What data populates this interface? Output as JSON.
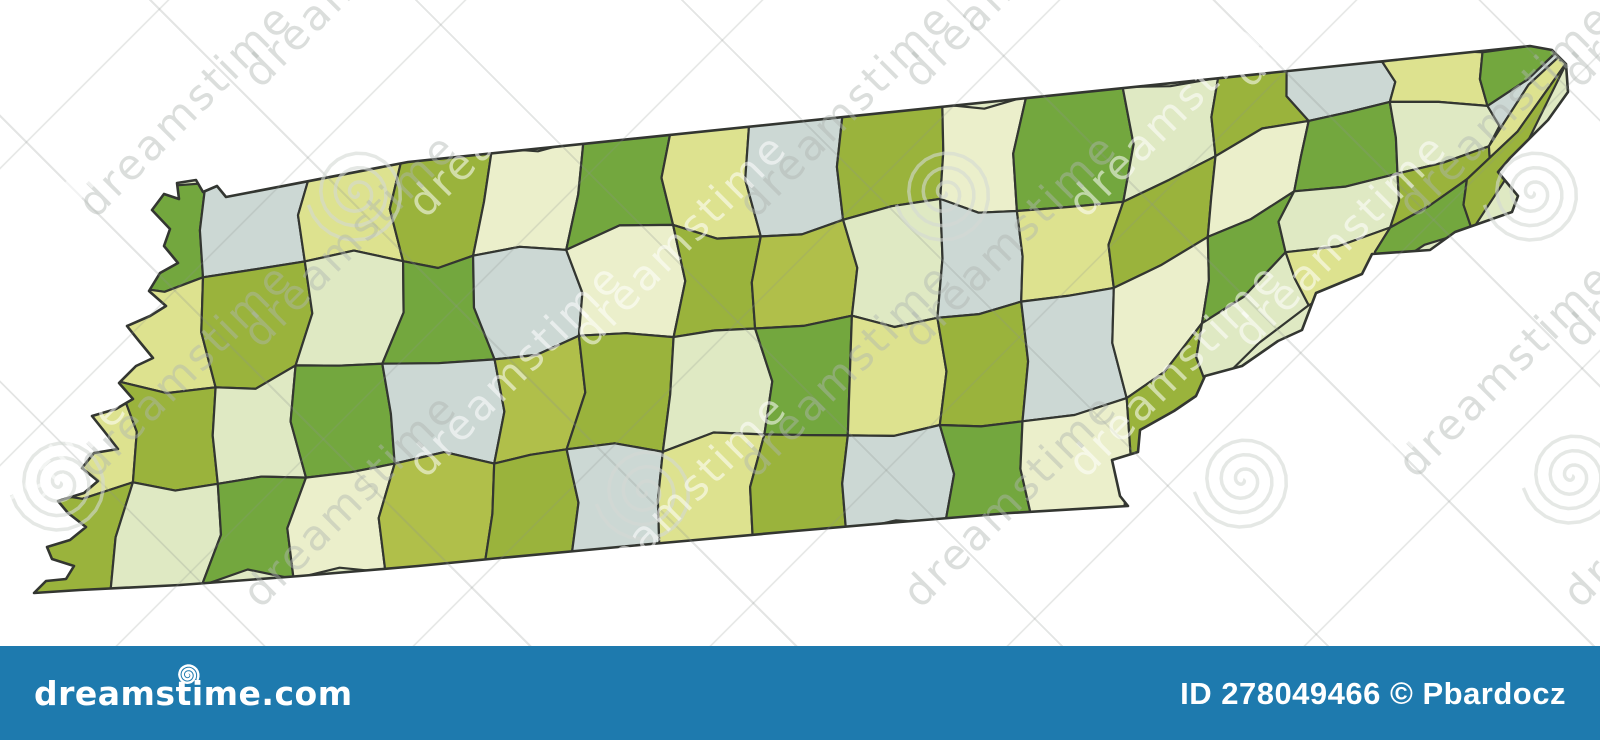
{
  "image": {
    "width": 1600,
    "height": 740,
    "background": "#ffffff"
  },
  "map": {
    "label": "tennessee-counties-political-map",
    "border_color": "#333631",
    "outline_stroke_width": 2.6,
    "county_stroke_width": 2.2,
    "underlay_color": "#dfe9c3",
    "palette": [
      "#9ab33c",
      "#73a73e",
      "#b0bf4a",
      "#dde28f",
      "#ebefcb",
      "#dfe9c3",
      "#ccd8d4",
      "#d9e3dc"
    ],
    "outline": [
      [
        152,
        210
      ],
      [
        164,
        194
      ],
      [
        179,
        199
      ],
      [
        177,
        183
      ],
      [
        196,
        180
      ],
      [
        203,
        192
      ],
      [
        217,
        186
      ],
      [
        226,
        197
      ],
      [
        408,
        162
      ],
      [
        1530,
        46
      ],
      [
        1552,
        50
      ],
      [
        1566,
        64
      ],
      [
        1568,
        92
      ],
      [
        1548,
        120
      ],
      [
        1510,
        158
      ],
      [
        1498,
        172
      ],
      [
        1518,
        196
      ],
      [
        1512,
        212
      ],
      [
        1455,
        232
      ],
      [
        1430,
        250
      ],
      [
        1372,
        254
      ],
      [
        1362,
        274
      ],
      [
        1316,
        293
      ],
      [
        1302,
        330
      ],
      [
        1278,
        341
      ],
      [
        1242,
        366
      ],
      [
        1205,
        376
      ],
      [
        1196,
        396
      ],
      [
        1174,
        411
      ],
      [
        1140,
        430
      ],
      [
        1138,
        452
      ],
      [
        1112,
        460
      ],
      [
        1120,
        496
      ],
      [
        1128,
        506
      ],
      [
        1010,
        513
      ],
      [
        900,
        522
      ],
      [
        795,
        531
      ],
      [
        640,
        545
      ],
      [
        500,
        558
      ],
      [
        418,
        566
      ],
      [
        300,
        576
      ],
      [
        180,
        585
      ],
      [
        80,
        590
      ],
      [
        34,
        593
      ],
      [
        46,
        581
      ],
      [
        66,
        579
      ],
      [
        74,
        566
      ],
      [
        52,
        559
      ],
      [
        47,
        547
      ],
      [
        70,
        540
      ],
      [
        86,
        527
      ],
      [
        68,
        513
      ],
      [
        58,
        501
      ],
      [
        84,
        493
      ],
      [
        98,
        481
      ],
      [
        82,
        468
      ],
      [
        94,
        453
      ],
      [
        118,
        449
      ],
      [
        104,
        431
      ],
      [
        92,
        416
      ],
      [
        116,
        409
      ],
      [
        133,
        399
      ],
      [
        119,
        383
      ],
      [
        136,
        366
      ],
      [
        153,
        358
      ],
      [
        139,
        341
      ],
      [
        127,
        326
      ],
      [
        150,
        316
      ],
      [
        166,
        306
      ],
      [
        149,
        291
      ],
      [
        160,
        273
      ],
      [
        178,
        263
      ],
      [
        164,
        246
      ],
      [
        170,
        229
      ]
    ],
    "north_line": [
      [
        140,
        192
      ],
      [
        408,
        156
      ],
      [
        1568,
        44
      ]
    ],
    "south_line": [
      [
        32,
        598
      ],
      [
        418,
        570
      ],
      [
        795,
        536
      ],
      [
        1008,
        518
      ],
      [
        1125,
        510
      ],
      [
        1160,
        424
      ],
      [
        1240,
        372
      ],
      [
        1310,
        304
      ],
      [
        1425,
        256
      ],
      [
        1520,
        204
      ],
      [
        1552,
        124
      ],
      [
        1568,
        60
      ]
    ],
    "grid": {
      "cols": 17,
      "rows": 4,
      "seed": 20230617,
      "vertex_jitter": 12,
      "edge_jitter": 13
    },
    "cell_colors": [
      [
        4,
        1,
        6,
        3,
        0,
        4,
        1,
        3,
        6,
        0,
        4,
        1,
        5,
        0,
        6,
        3,
        1
      ],
      [
        6,
        3,
        0,
        5,
        1,
        6,
        4,
        0,
        2,
        5,
        6,
        3,
        0,
        4,
        1,
        5,
        6
      ],
      [
        3,
        0,
        5,
        1,
        6,
        2,
        0,
        5,
        1,
        3,
        0,
        6,
        4,
        1,
        5,
        0,
        3
      ],
      [
        0,
        5,
        1,
        4,
        2,
        0,
        6,
        3,
        0,
        6,
        1,
        4,
        0,
        5,
        3,
        1,
        0
      ]
    ]
  },
  "watermark": {
    "text": "dreamstime",
    "angle_deg": -45,
    "font_size": 42,
    "word_color_light": "rgba(255,255,255,0.55)",
    "word_color_gray": "rgba(176,182,178,0.45)",
    "spiral_color": "rgba(212,216,212,0.60)",
    "word_grid": {
      "cols": 6,
      "rows": 5,
      "x0": -80,
      "y0": 55,
      "dx": 330,
      "dy": 130,
      "stagger": 165
    },
    "spiral_positions": [
      [
        357,
        193
      ],
      [
        945,
        193
      ],
      [
        1533,
        193
      ],
      [
        60,
        483
      ],
      [
        645,
        492
      ],
      [
        1243,
        480
      ],
      [
        1572,
        476
      ]
    ]
  },
  "footer": {
    "background": "#1e7aae",
    "text_color": "#ffffff",
    "logo_text": "dreamstime.com",
    "credit_text": "ID 278049466 © Pbardocz"
  }
}
